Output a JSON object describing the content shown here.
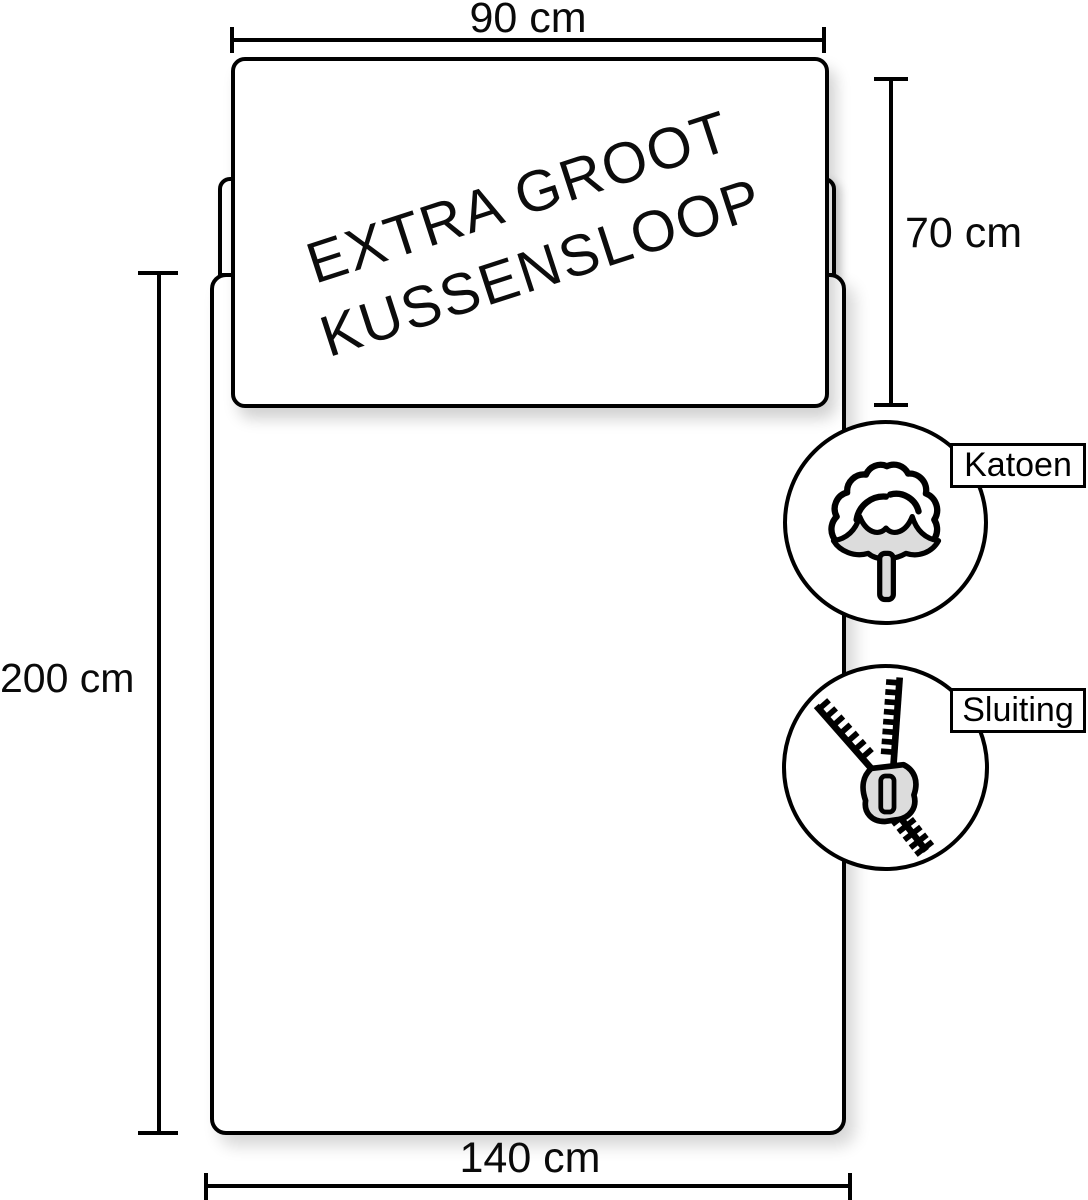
{
  "diagram": {
    "pillow_label": {
      "line1": "EXTRA GROOT",
      "line2": "KUSSENSLOOP"
    },
    "dimensions": {
      "pillow_width": "90 cm",
      "pillow_height": "70 cm",
      "duvet_height": "200 cm",
      "duvet_width": "140 cm"
    },
    "features": [
      {
        "label": "Katoen",
        "icon": "cotton-flower-icon"
      },
      {
        "label": "Sluiting",
        "icon": "zipper-icon"
      }
    ],
    "colors": {
      "line": "#000000",
      "background": "#ffffff",
      "icon_fill": "#dcdcdc",
      "shadow": "rgba(0,0,0,0.16)"
    }
  }
}
